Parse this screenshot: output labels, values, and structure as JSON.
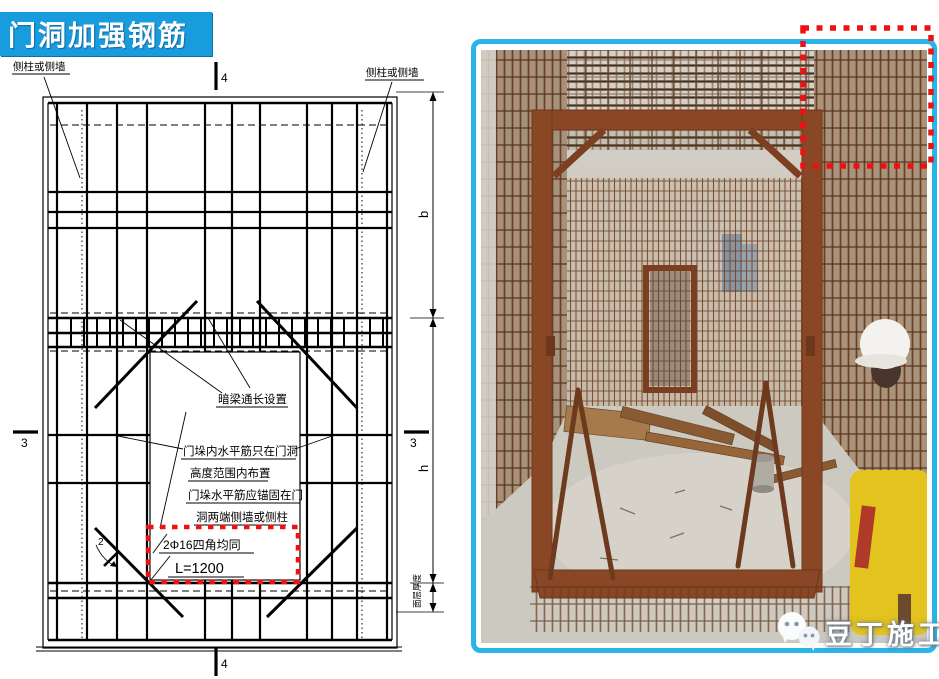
{
  "title": {
    "label": "门洞加强钢筋"
  },
  "colors": {
    "title_bg": "#189CDE",
    "photo_border": "#2AB5E9",
    "highlight_red": "#EE1111",
    "rust": "#7E4526"
  },
  "diagram": {
    "side_label_left": "侧柱或侧墙",
    "side_label_right": "侧柱或侧墙",
    "section_top": "4",
    "section_bottom": "4",
    "section_left": "3",
    "section_right": "3",
    "section_diagonal": "2",
    "dim_b": "b",
    "dim_h": "h",
    "dim_floor": "面层厚度",
    "notes": {
      "beam": "暗梁通长设置",
      "pier_line1": "门垛内水平筋只在门洞",
      "pier_line2": "高度范围内布置",
      "anchor_line1": "门垛水平筋应锚固在门",
      "anchor_line2": "洞两端侧墙或侧柱"
    },
    "callout": {
      "bars": "2Φ16四角均同",
      "length": "L=1200"
    }
  },
  "photo": {
    "watermark": "豆丁施工"
  }
}
